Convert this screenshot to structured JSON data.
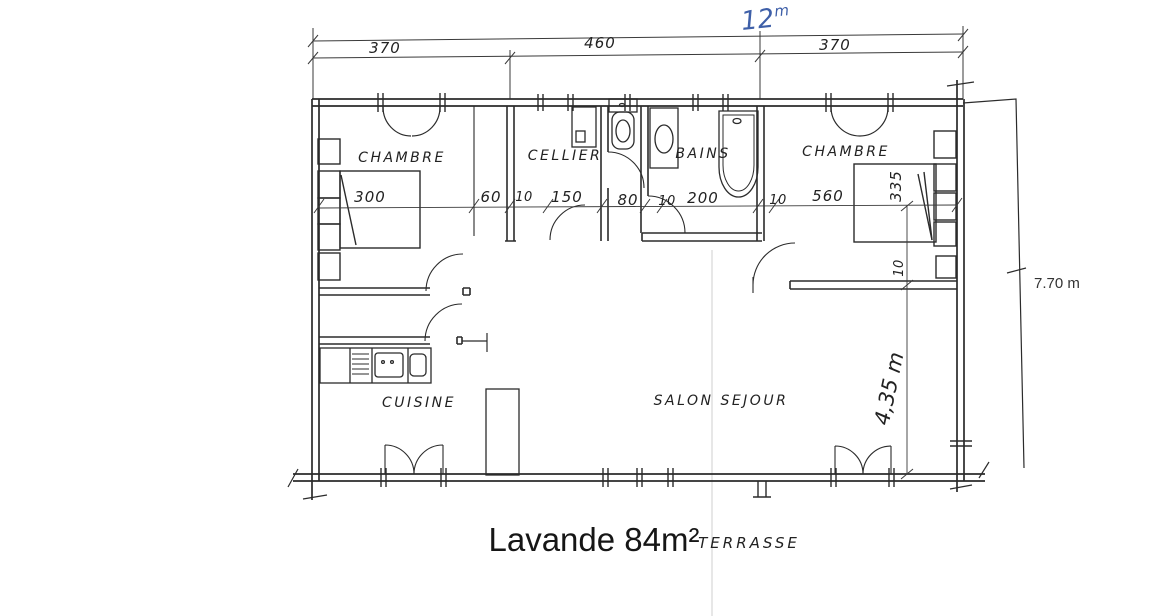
{
  "colors": {
    "ink": "#2b2b2b",
    "handwriting_blue": "#3e5fa8",
    "paper": "#ffffff"
  },
  "caption": {
    "title": "Lavande 84m²",
    "terrasse": "TERRASSE"
  },
  "rooms": {
    "chambre_left": "CHAMBRE",
    "cellier": "CELLIER",
    "bains": "BAINS",
    "chambre_right": "CHAMBRE",
    "cuisine": "CUISINE",
    "salon": "SALON SEJOUR"
  },
  "dimensions": {
    "overall_width_value": "12",
    "overall_width_unit": "m",
    "overall_height": "7.70 m",
    "top_row": [
      "370",
      "460",
      "370"
    ],
    "mid_row": [
      "300",
      "60",
      "10",
      "150",
      "80",
      "10",
      "200",
      "10",
      "560"
    ],
    "right_column": [
      "335",
      "10",
      "4,35 m"
    ]
  }
}
